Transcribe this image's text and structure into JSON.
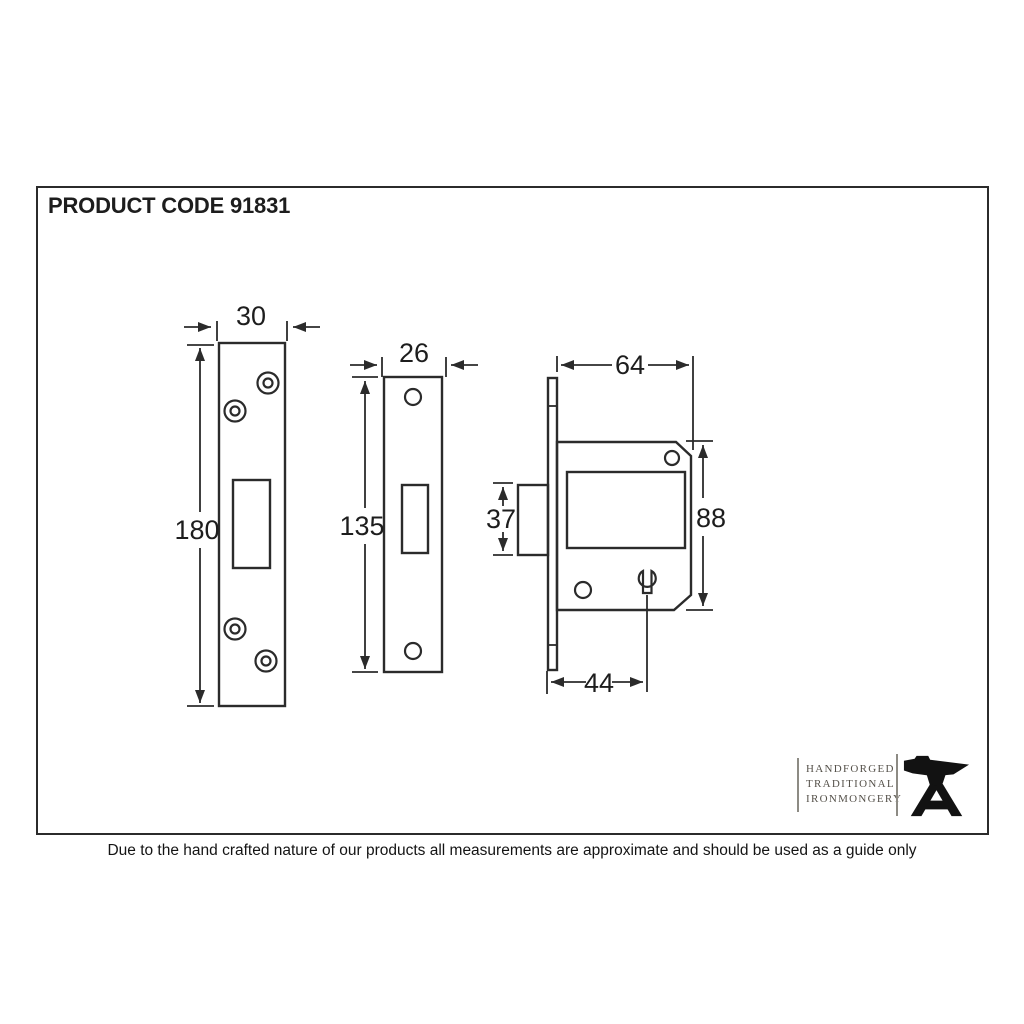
{
  "sheet": {
    "title": "PRODUCT CODE 91831",
    "disclaimer": "Due to the hand crafted nature of our products all measurements are approximate and should be used as a guide only"
  },
  "logo": {
    "lines": [
      "HANDFORGED",
      "TRADITIONAL",
      "IRONMONGERY"
    ],
    "icon": "anvil-icon"
  },
  "drawing": {
    "views": [
      {
        "name": "strike-plate-front-view",
        "dims": {
          "width": "30",
          "height": "180"
        }
      },
      {
        "name": "faceplate-front-view",
        "dims": {
          "width": "26",
          "height": "135"
        }
      },
      {
        "name": "lock-case-side-view",
        "dims": {
          "depth": "64",
          "height": "88",
          "bolt": "37",
          "backset": "44"
        }
      }
    ]
  },
  "colors": {
    "line": "#2b2b2b",
    "label": "#1d1d1d",
    "logo_text": "#55514a",
    "background": "#ffffff"
  }
}
